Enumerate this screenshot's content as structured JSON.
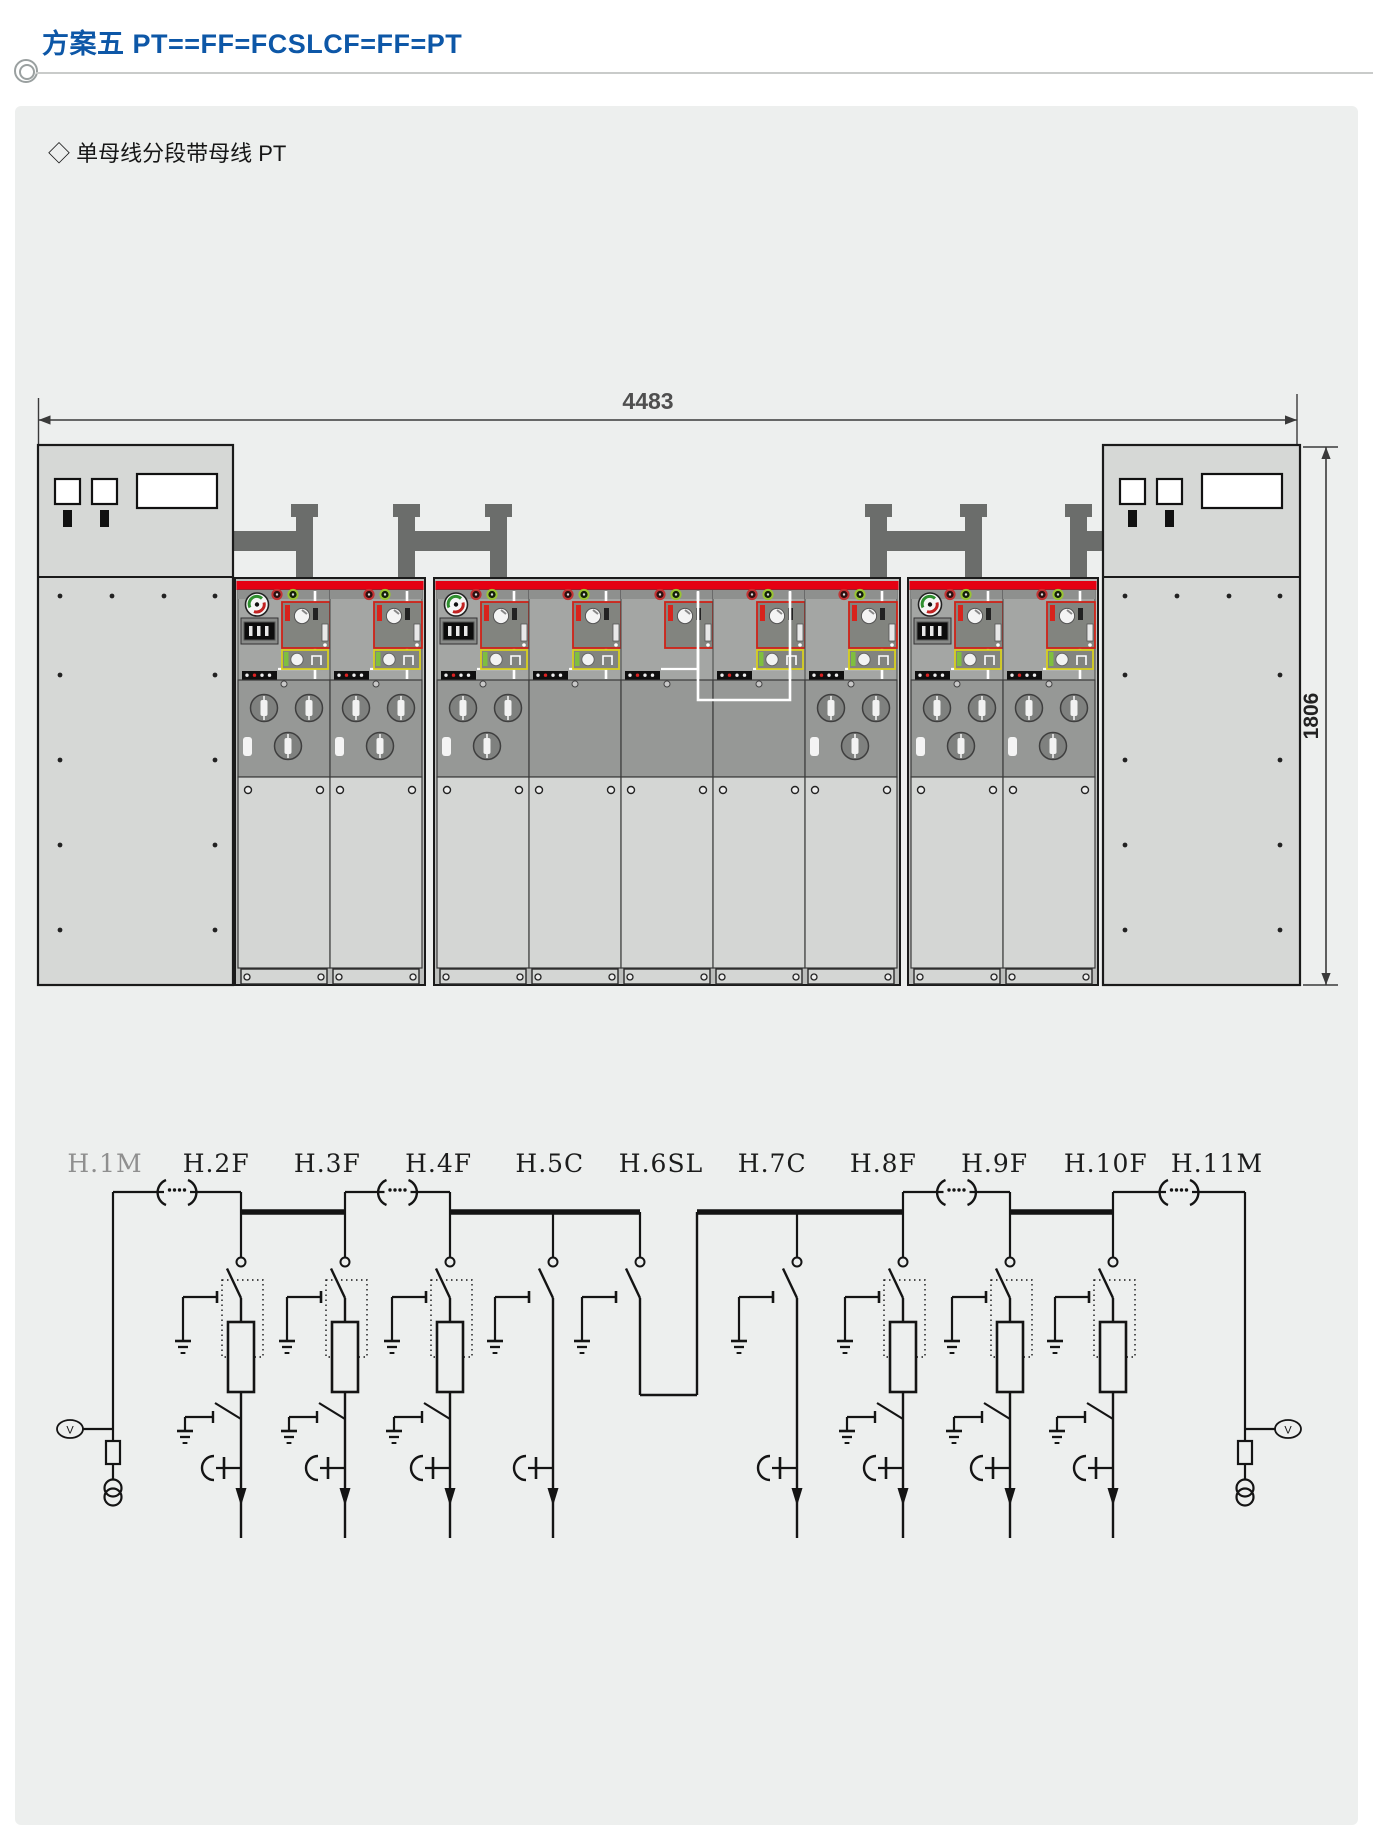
{
  "header": {
    "title": "方案五 PT==FF=FCSLCF=FF=PT"
  },
  "section": {
    "subtitle": "◇ 单母线分段带母线 PT"
  },
  "colors": {
    "accent_blue": "#0d57a7",
    "busbar_red": "#e50012",
    "content_bg": "#edefee",
    "pipe_gray": "#6b6d6b"
  },
  "cabinet_drawing": {
    "overall_width_mm": "4483",
    "overall_height_mm": "1806",
    "left_end_cabinet": {
      "name": "PT end cabinet H.1M"
    },
    "right_end_cabinet": {
      "name": "PT end cabinet H.11M"
    },
    "groups": [
      {
        "panels": [
          {
            "unit": "H.2F",
            "type": "F"
          },
          {
            "unit": "H.3F",
            "type": "F"
          }
        ]
      },
      {
        "panels": [
          {
            "unit": "H.4F",
            "type": "F"
          },
          {
            "unit": "H.5C",
            "type": "C"
          },
          {
            "unit": "H.6SL",
            "type": "SL"
          },
          {
            "unit": "H.7C",
            "type": "C"
          },
          {
            "unit": "H.8F",
            "type": "F"
          }
        ]
      },
      {
        "panels": [
          {
            "unit": "H.9F",
            "type": "F"
          },
          {
            "unit": "H.10F",
            "type": "F"
          }
        ]
      }
    ]
  },
  "schematic": {
    "units": [
      {
        "label": "H.1M",
        "type": "M"
      },
      {
        "label": "H.2F",
        "type": "F"
      },
      {
        "label": "H.3F",
        "type": "F"
      },
      {
        "label": "H.4F",
        "type": "F"
      },
      {
        "label": "H.5C",
        "type": "C"
      },
      {
        "label": "H.6SL",
        "type": "SL"
      },
      {
        "label": "H.7C",
        "type": "C"
      },
      {
        "label": "H.8F",
        "type": "F"
      },
      {
        "label": "H.9F",
        "type": "F"
      },
      {
        "label": "H.10F",
        "type": "F"
      },
      {
        "label": "H.11M",
        "type": "M"
      }
    ],
    "bridge_pairs": [
      [
        0,
        1
      ],
      [
        2,
        3
      ],
      [
        7,
        8
      ],
      [
        9,
        10
      ]
    ]
  }
}
